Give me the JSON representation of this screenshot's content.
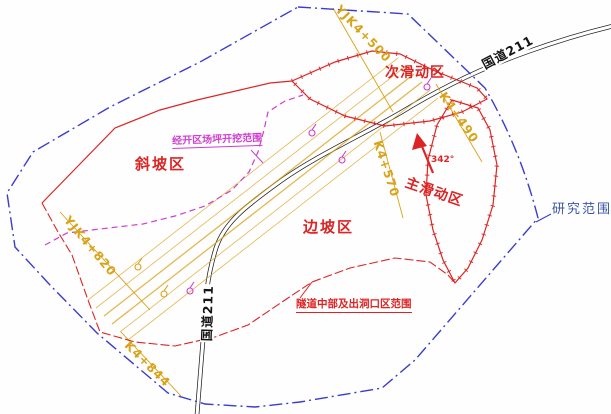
{
  "drawing": {
    "study_boundary_label": "研究范围",
    "zones": {
      "secondary_slide": "次滑动区",
      "main_slide": "主滑动区",
      "slope": "斜坡区",
      "side_slope": "边坡区"
    },
    "road": {
      "name_top": "国道211",
      "name_bottom": "国道211"
    },
    "chainages": {
      "yjk4_500": "YJK4+500",
      "k4_490": "K4+490",
      "k4_570": "K4+570",
      "yjk4_820": "YJK4+820",
      "k4_844": "K4+844"
    },
    "callouts": {
      "excavation": "经开区场坪开挖范围",
      "tunnel": "隧道中部及出洞口区范围"
    },
    "north_arrow": {
      "azimuth": "342°"
    },
    "colors": {
      "study_boundary": "#3b3bd0",
      "zone_line": "#dd2424",
      "excavation_line": "#cf3ecf",
      "chainage": "#d9a217",
      "road": "#1c1c1c",
      "study_label": "#3a56a8"
    }
  }
}
